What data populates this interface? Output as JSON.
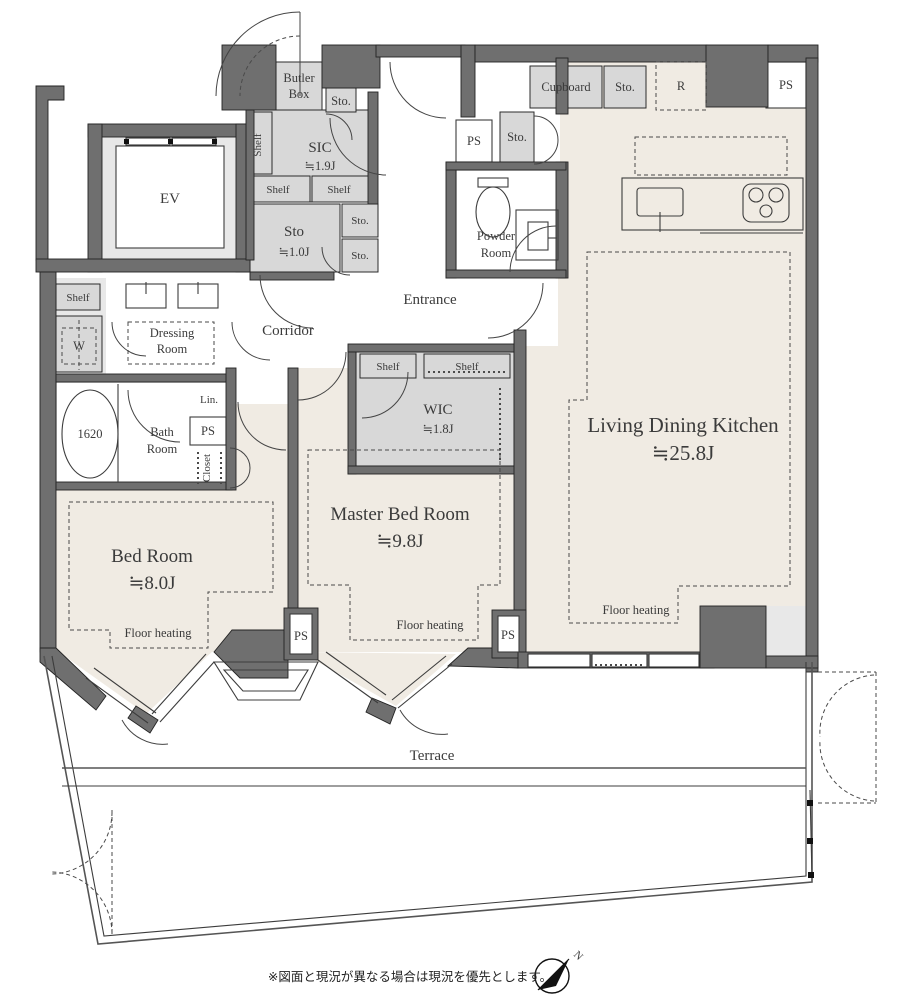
{
  "colors": {
    "wall": "#6f6f6f",
    "room_beige": "#f0ebe3",
    "closet_gray": "#d8d8d8",
    "light_gray": "#e8e8e8"
  },
  "labels": {
    "ev": "EV",
    "butler1": "Butler",
    "butler2": "Box",
    "sto_butler": "Sto.",
    "shelf_sic": "Shelf",
    "sic1": "SIC",
    "sic2": "≒1.9J",
    "shelf_a": "Shelf",
    "shelf_b": "Shelf",
    "sto_room1": "Sto",
    "sto_room2": "≒1.0J",
    "sto_box1": "Sto.",
    "sto_box2": "Sto.",
    "ps_hall": "PS",
    "sto_kitchen": "Sto.",
    "powder1": "Powder",
    "powder2": "Room",
    "cupboard": "Cupboard",
    "sto_cup": "Sto.",
    "fridge": "R",
    "ps_tr": "PS",
    "entrance": "Entrance",
    "corridor": "Corridor",
    "dressing1": "Dressing",
    "dressing2": "Room",
    "shelf_w": "Shelf",
    "washer": "W",
    "tub": "1620",
    "bath1": "Bath",
    "bath2": "Room",
    "lin": "Lin.",
    "ps_lin": "PS",
    "closet": "Closet",
    "shelf_wic1": "Shelf",
    "shelf_wic2": "Shelf",
    "wic1": "WIC",
    "wic2": "≒1.8J",
    "ldk1": "Living Dining Kitchen",
    "ldk2": "≒25.8J",
    "master1": "Master Bed Room",
    "master2": "≒9.8J",
    "bed1": "Bed Room",
    "bed2": "≒8.0J",
    "fh_bed": "Floor heating",
    "fh_master": "Floor heating",
    "fh_ldk": "Floor heating",
    "ps_b1": "PS",
    "ps_b2": "PS",
    "terrace": "Terrace",
    "note": "※図面と現況が異なる場合は現況を優先とします。",
    "north": "N"
  }
}
